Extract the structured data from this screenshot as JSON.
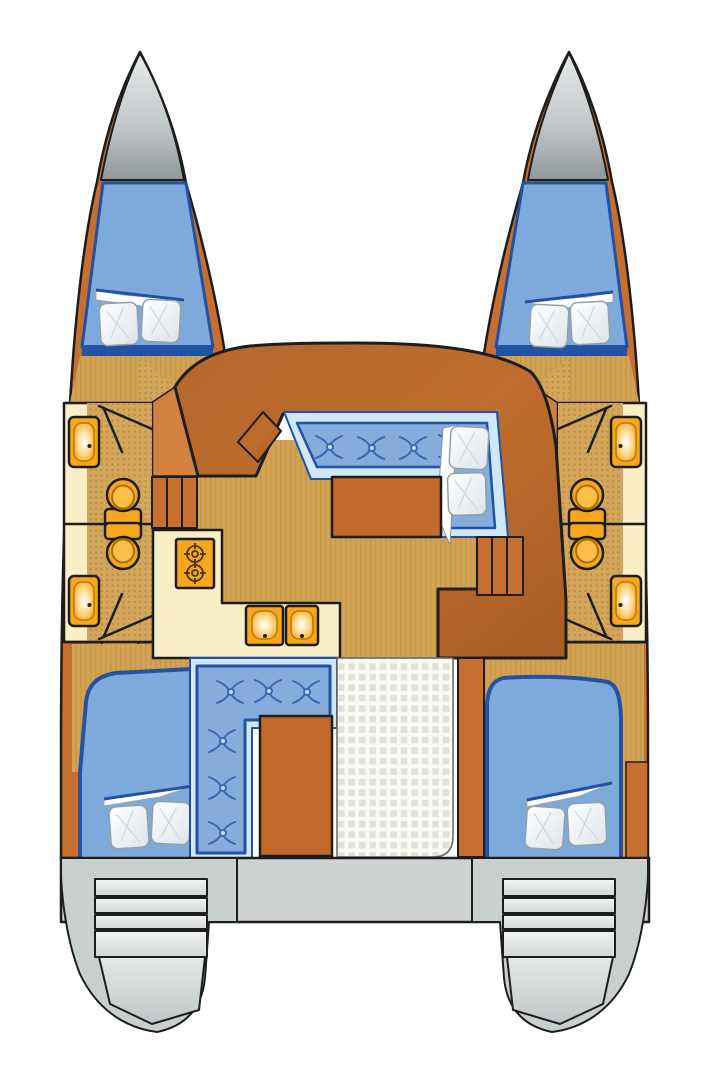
{
  "title": "Catamaran interior deck plan (top view)",
  "type": "boat-floor-plan",
  "colors": {
    "hull": "#c66f31",
    "hullLight": "#d3813f",
    "deck": "#b5662b",
    "deckDark": "#a85d24",
    "wood": "#c16a2c",
    "floor": "#d3a355",
    "floorStripe": "#bb8e3c",
    "showerBase": "#d4a65c",
    "showerDot": "#b8903f",
    "cream": "#f9efc6",
    "fixture": "#f6a71d",
    "fixtureLight": "#fbbf45",
    "fixtureRim": "#a96e00",
    "bed": "#7ea9db",
    "cushion": "#86acdc",
    "cushionLight": "#cfe7f7",
    "navy": "#2152a3",
    "tuft": "#3a68b2",
    "outline": "#1d1d1d",
    "bowLight": "#e8eaeb",
    "bowDark": "#8f989c",
    "band": "#ced2d3",
    "ext": "#c9cecf",
    "stepLight": "#f2f4f4",
    "stepDark": "#d2d6d7",
    "gridBg": "#fafaf6",
    "gridCell": "#e2e2da",
    "pillowHi": "#ffffff",
    "pillowLo": "#dce4e9",
    "white": "#ffffff"
  },
  "vessel": {
    "kind": "catamaran",
    "view": "top-down interior layout",
    "hulls": [
      {
        "side": "port-left",
        "spaces": [
          {
            "name": "bow anchor locker"
          },
          {
            "name": "forward double cabin",
            "pillows": 2,
            "bedding": "folded sheet"
          },
          {
            "name": "forward bathroom",
            "fixtures": [
              "sink",
              "toilet",
              "shower floor"
            ]
          },
          {
            "name": "aft bathroom",
            "fixtures": [
              "sink",
              "toilet",
              "shower floor"
            ]
          },
          {
            "name": "aft double cabin",
            "pillows": 2,
            "bedding": "folded sheet"
          },
          {
            "name": "stern platform",
            "steps": 4
          }
        ]
      },
      {
        "side": "starboard-right",
        "spaces": [
          {
            "name": "bow anchor locker"
          },
          {
            "name": "forward double cabin",
            "pillows": 2,
            "bedding": "folded sheet"
          },
          {
            "name": "forward bathroom",
            "fixtures": [
              "sink",
              "toilet",
              "shower floor"
            ]
          },
          {
            "name": "aft bathroom",
            "fixtures": [
              "sink",
              "toilet",
              "shower floor"
            ]
          },
          {
            "name": "aft double cabin",
            "pillows": 2,
            "bedding": "folded sheet"
          },
          {
            "name": "stern platform",
            "steps": 4
          }
        ]
      }
    ],
    "bridgedeck": {
      "salon": {
        "settee": "U-shaped tufted bench",
        "tufts": 4,
        "pillows": 2,
        "table": 1,
        "chart_table": 1
      },
      "galley": {
        "stove_burners": 2,
        "sinks": 2,
        "counter": "L-shaped"
      },
      "companionways": [
        {
          "side": "left",
          "treads": 3
        },
        {
          "side": "right",
          "treads": 3
        }
      ],
      "cockpit": {
        "settee": "L-shaped tufted bench",
        "tufts": 6,
        "table": 1,
        "floor": "white non-skid grid"
      }
    },
    "totals": {
      "cabins": 4,
      "bathrooms": 4,
      "toilets": 4,
      "bathroom_sinks": 4,
      "galley_sinks": 2,
      "burners": 2,
      "pillows": 10
    }
  }
}
